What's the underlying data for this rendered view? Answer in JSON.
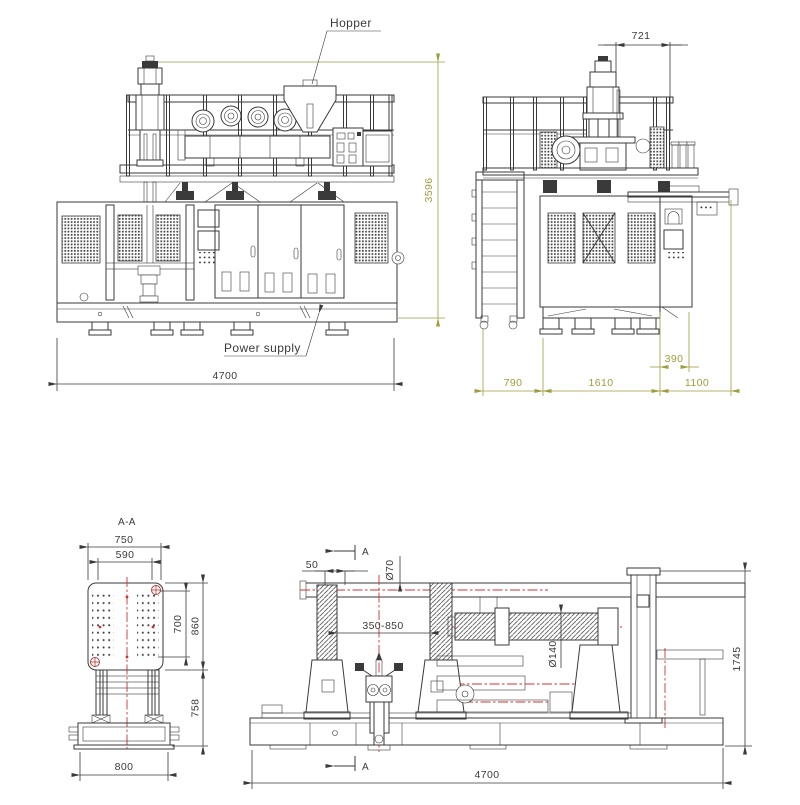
{
  "labels": {
    "hopper": "Hopper",
    "power_supply": "Power supply",
    "section": "A-A",
    "section_arrow": "A"
  },
  "front_view": {
    "dims": {
      "overall_width": "4700",
      "overall_height": "3596"
    }
  },
  "side_view": {
    "dims": {
      "head_offset": "721",
      "ladder": "790",
      "body": "1610",
      "conveyor": "1100",
      "offset": "390"
    }
  },
  "section_view": {
    "dims": {
      "platen_width": "750",
      "inner_width": "590",
      "hole_height": "700",
      "platen_height": "860",
      "leg_height": "758",
      "base_width": "800"
    }
  },
  "station_view": {
    "dims": {
      "stroke": "50",
      "tie_bar": "Ø70",
      "travel": "350-850",
      "shaft": "Ø140",
      "height": "1745",
      "length": "4700"
    }
  },
  "colors": {
    "line": "#3a3a3a",
    "dimension_olive": "#9e9e3d",
    "centerline_red": "#cc3333"
  }
}
